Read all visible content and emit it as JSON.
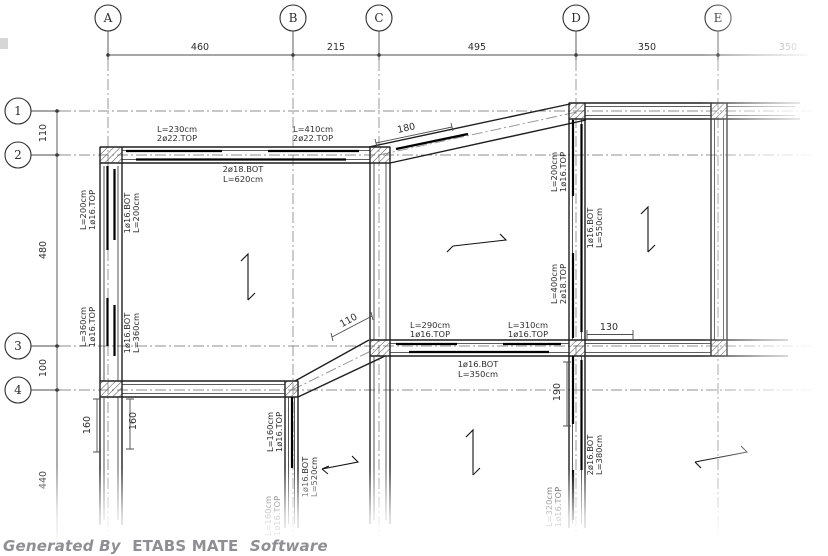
{
  "colors": {
    "beam_line": "#1f1f1f",
    "grid_line": "#8f8f8f",
    "dim_line": "#4d4d4d",
    "text": "#2d2d2d",
    "footer_text": "#8e8e93",
    "background": "#ffffff"
  },
  "footer": {
    "generated_by": "Generated By",
    "app_name": "ETABS MATE",
    "software_word": "Software"
  },
  "grid_cols": [
    {
      "label": "A",
      "x": 108
    },
    {
      "label": "B",
      "x": 293
    },
    {
      "label": "C",
      "x": 379
    },
    {
      "label": "D",
      "x": 576
    },
    {
      "label": "E",
      "x": 718
    }
  ],
  "grid_rows": [
    {
      "label": "1",
      "y": 111
    },
    {
      "label": "2",
      "y": 155
    },
    {
      "label": "3",
      "y": 346
    },
    {
      "label": "4",
      "y": 390
    }
  ],
  "top_dims": [
    {
      "text": "460",
      "x": 200,
      "y": 50
    },
    {
      "text": "215",
      "x": 336,
      "y": 50
    },
    {
      "text": "495",
      "x": 477,
      "y": 50
    },
    {
      "text": "350",
      "x": 647,
      "y": 50
    },
    {
      "text": "350",
      "x": 788,
      "y": 50
    }
  ],
  "side_dims": [
    {
      "text": "110",
      "x": 46,
      "y": 133,
      "rot": -90
    },
    {
      "text": "480",
      "x": 46,
      "y": 250,
      "rot": -90
    },
    {
      "text": "100",
      "x": 46,
      "y": 368,
      "rot": -90
    },
    {
      "text": "440",
      "x": 46,
      "y": 480,
      "rot": -90
    }
  ],
  "small_dims": [
    {
      "text": "130",
      "x": 609,
      "y": 330,
      "rot": 0
    },
    {
      "text": "190",
      "x": 560,
      "y": 392,
      "rot": -90
    },
    {
      "text": "160",
      "x": 90,
      "y": 425,
      "rot": -90
    },
    {
      "text": "160",
      "x": 136,
      "y": 421,
      "rot": -90
    },
    {
      "text": "180",
      "x": 407,
      "y": 131,
      "rot": -13
    },
    {
      "text": "110",
      "x": 350,
      "y": 323,
      "rot": -29
    }
  ],
  "rebar_labels": [
    {
      "text": "L=230cm",
      "x": 177,
      "y": 132,
      "rot": 0
    },
    {
      "text": "2ø22.TOP",
      "x": 177,
      "y": 141,
      "rot": 0
    },
    {
      "text": "L=410cm",
      "x": 313,
      "y": 132,
      "rot": 0
    },
    {
      "text": "2ø22.TOP",
      "x": 313,
      "y": 141,
      "rot": 0
    },
    {
      "text": "2ø18.BOT",
      "x": 243,
      "y": 172,
      "rot": 0
    },
    {
      "text": "L=620cm",
      "x": 243,
      "y": 182,
      "rot": 0
    },
    {
      "text": "L=290cm",
      "x": 430,
      "y": 328,
      "rot": 0
    },
    {
      "text": "1ø16.TOP",
      "x": 430,
      "y": 337,
      "rot": 0
    },
    {
      "text": "L=310cm",
      "x": 528,
      "y": 328,
      "rot": 0
    },
    {
      "text": "1ø16.TOP",
      "x": 528,
      "y": 337,
      "rot": 0
    },
    {
      "text": "1ø16.BOT",
      "x": 478,
      "y": 367,
      "rot": 0
    },
    {
      "text": "L=350cm",
      "x": 478,
      "y": 377,
      "rot": 0
    },
    {
      "text": "L=200cm",
      "x": 86,
      "y": 210,
      "rot": -90
    },
    {
      "text": "1ø16.TOP",
      "x": 95,
      "y": 210,
      "rot": -90
    },
    {
      "text": "1ø16.BOT",
      "x": 130,
      "y": 213,
      "rot": -90
    },
    {
      "text": "L=200cm",
      "x": 139,
      "y": 213,
      "rot": -90
    },
    {
      "text": "L=360cm",
      "x": 86,
      "y": 327,
      "rot": -90
    },
    {
      "text": "1ø16.TOP",
      "x": 95,
      "y": 327,
      "rot": -90
    },
    {
      "text": "1ø16.BOT",
      "x": 130,
      "y": 333,
      "rot": -90
    },
    {
      "text": "L=360cm",
      "x": 139,
      "y": 333,
      "rot": -90
    },
    {
      "text": "L=200cm",
      "x": 557,
      "y": 172,
      "rot": -90
    },
    {
      "text": "1ø16.TOP",
      "x": 566,
      "y": 172,
      "rot": -90
    },
    {
      "text": "L=400cm",
      "x": 557,
      "y": 284,
      "rot": -90
    },
    {
      "text": "2ø18.TOP",
      "x": 566,
      "y": 284,
      "rot": -90
    },
    {
      "text": "1ø16.BOT",
      "x": 593,
      "y": 228,
      "rot": -90
    },
    {
      "text": "L=550cm",
      "x": 602,
      "y": 228,
      "rot": -90
    },
    {
      "text": "L=160cm",
      "x": 273,
      "y": 432,
      "rot": -90
    },
    {
      "text": "1ø16.TOP",
      "x": 282,
      "y": 432,
      "rot": -90
    },
    {
      "text": "1ø16.BOT",
      "x": 308,
      "y": 477,
      "rot": -90
    },
    {
      "text": "L=520cm",
      "x": 317,
      "y": 477,
      "rot": -90
    },
    {
      "text": "2ø16.BOT",
      "x": 593,
      "y": 455,
      "rot": -90
    },
    {
      "text": "L=380cm",
      "x": 602,
      "y": 455,
      "rot": -90
    },
    {
      "text": "L=320cm",
      "x": 552,
      "y": 507,
      "rot": -90
    },
    {
      "text": "1ø16.TOP",
      "x": 561,
      "y": 507,
      "rot": -90
    },
    {
      "text": "L=160cm",
      "x": 271,
      "y": 516,
      "rot": -90
    },
    {
      "text": "1ø16.TOP",
      "x": 280,
      "y": 516,
      "rot": -90
    }
  ]
}
